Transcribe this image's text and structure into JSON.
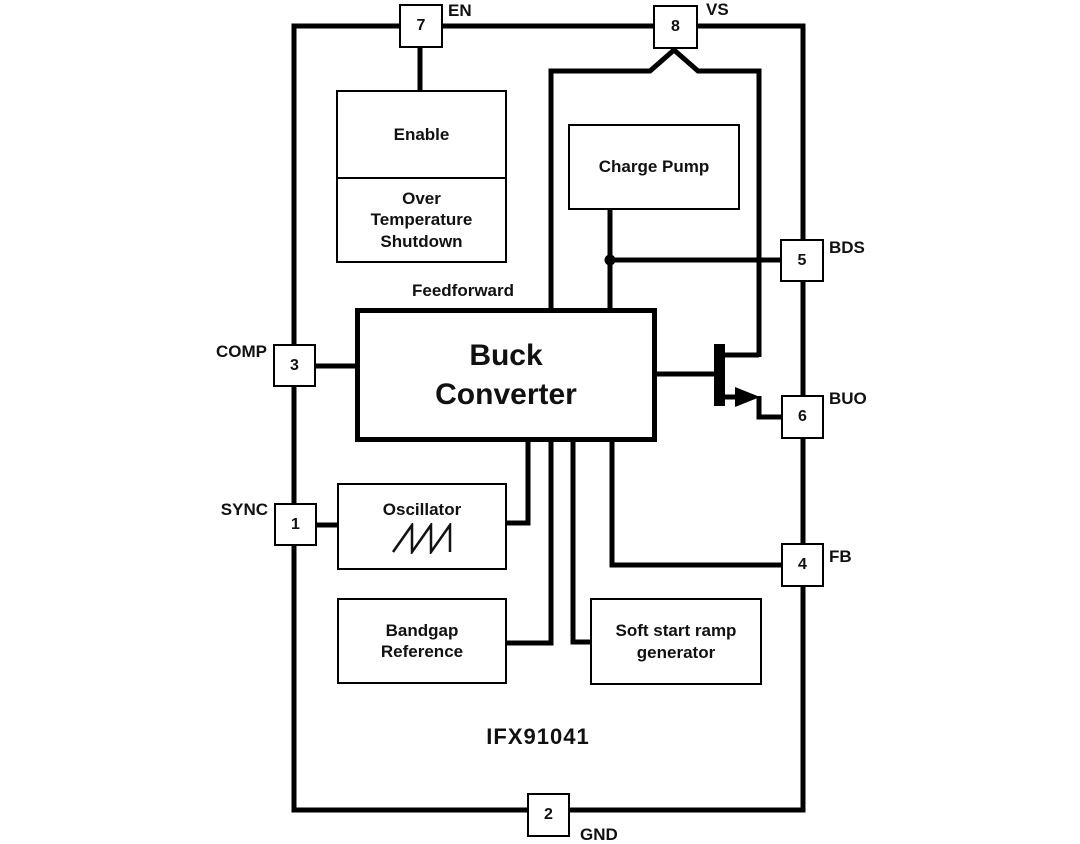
{
  "part_number": "IFX91041",
  "labels": {
    "feedforward": "Feedforward"
  },
  "blocks": {
    "enable": "Enable",
    "over_temperature": "Over Temperature Shutdown",
    "charge_pump": "Charge Pump",
    "buck_converter": "Buck Converter",
    "oscillator": "Oscillator",
    "bandgap": "Bandgap Reference",
    "soft_start": "Soft start ramp generator"
  },
  "pins": {
    "en": {
      "number": "7",
      "label": "EN"
    },
    "vs": {
      "number": "8",
      "label": "VS"
    },
    "bds": {
      "number": "5",
      "label": "BDS"
    },
    "buo": {
      "number": "6",
      "label": "BUO"
    },
    "fb": {
      "number": "4",
      "label": "FB"
    },
    "comp": {
      "number": "3",
      "label": "COMP"
    },
    "sync": {
      "number": "1",
      "label": "SYNC"
    },
    "gnd": {
      "number": "2",
      "label": "GND"
    }
  },
  "icons": {
    "sawtooth": "sawtooth-waveform",
    "transistor": "npn-output-transistor"
  },
  "colors": {
    "line": "#000000",
    "background": "#ffffff",
    "text": "#111111"
  }
}
